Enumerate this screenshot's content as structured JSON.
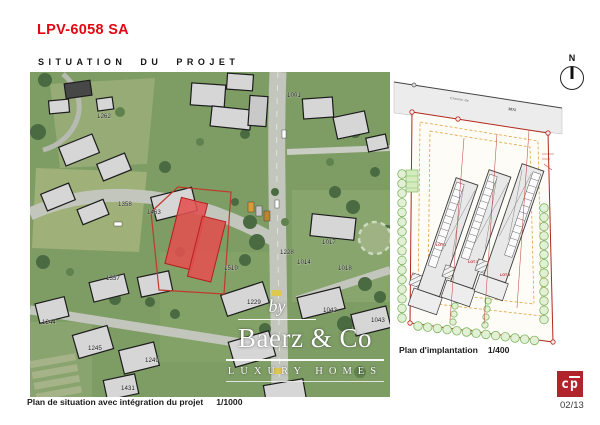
{
  "page": {
    "title": "LPV-6058 SA",
    "subtitle": "SITUATION DU PROJET",
    "page_number": "02/13",
    "logo_letter_c": "c",
    "logo_letter_p": "p"
  },
  "colors": {
    "accent_red": "#e30613",
    "logo_red": "#b2242c",
    "parcel_fill_red": "#e25050",
    "parcel_outline_red": "#b51f1f",
    "plan_boundary_red": "#b3281e",
    "plan_setback_orange": "#e2a244",
    "hedge_green": "#7fb55e",
    "grass_green": "#7e9d65"
  },
  "map": {
    "caption": "Plan de situation avec intégration du projet",
    "scale": "1/1000",
    "parcels": [
      {
        "t": "1262",
        "x": 67,
        "y": 46
      },
      {
        "t": "1001",
        "x": 257,
        "y": 25
      },
      {
        "t": "1017",
        "x": 292,
        "y": 172
      },
      {
        "t": "1018",
        "x": 308,
        "y": 198
      },
      {
        "t": "1463",
        "x": 117,
        "y": 142
      },
      {
        "t": "1358",
        "x": 88,
        "y": 134
      },
      {
        "t": "1357",
        "x": 76,
        "y": 208
      },
      {
        "t": "1519",
        "x": 194,
        "y": 198
      },
      {
        "t": "1228",
        "x": 250,
        "y": 182
      },
      {
        "t": "1014",
        "x": 267,
        "y": 192
      },
      {
        "t": "1229",
        "x": 217,
        "y": 232
      },
      {
        "t": "1042",
        "x": 293,
        "y": 240
      },
      {
        "t": "1043",
        "x": 341,
        "y": 250
      },
      {
        "t": "1245",
        "x": 58,
        "y": 278
      },
      {
        "t": "1244",
        "x": 12,
        "y": 252
      },
      {
        "t": "1249",
        "x": 115,
        "y": 290
      },
      {
        "t": "1431",
        "x": 91,
        "y": 318
      }
    ]
  },
  "plan": {
    "caption": "Plan d'implantation",
    "scale": "1/400",
    "road_name": "Chemin de",
    "road_number": "1071",
    "north_label": "N",
    "lots": [
      {
        "t": "LOT 1",
        "x": 44,
        "y": 188
      },
      {
        "t": "LOT 2",
        "x": 76,
        "y": 205
      },
      {
        "t": "LOT 3",
        "x": 108,
        "y": 218
      }
    ]
  },
  "watermark": {
    "prefix": "by",
    "name": "Baerz & Co",
    "tagline": "LUXURY HOMES"
  }
}
